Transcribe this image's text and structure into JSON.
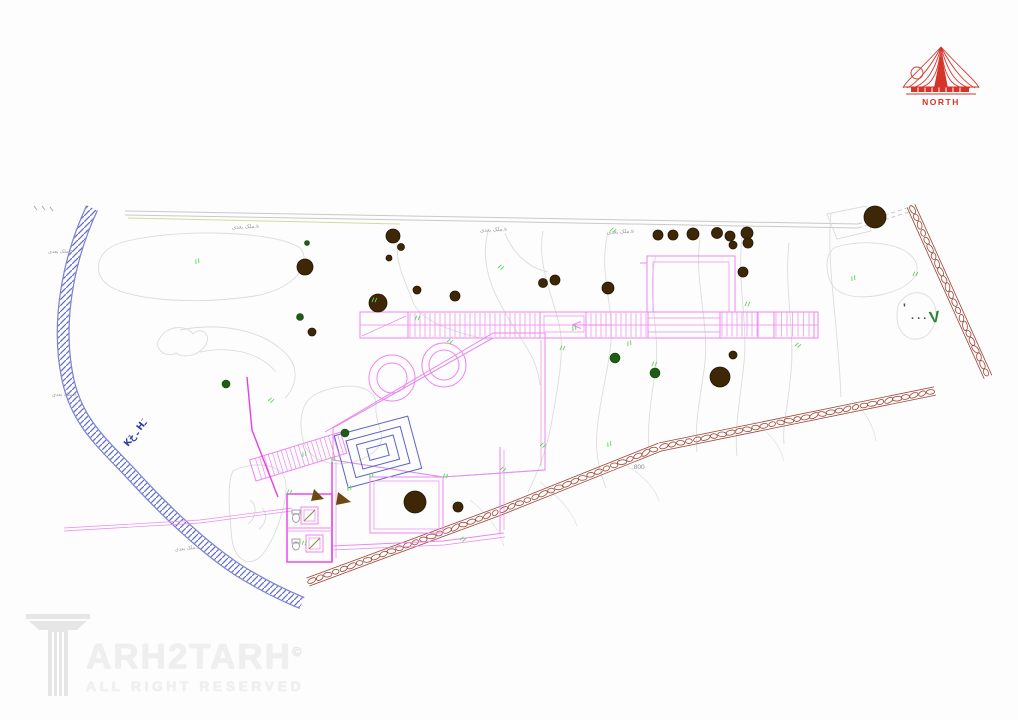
{
  "page": {
    "background": "#fdfdfd"
  },
  "north": {
    "label": "NORTH",
    "color": "#d5342b"
  },
  "watermark": {
    "brand": "ARH2TARH",
    "copyright": "©",
    "tagline": "ALL RIGHT RESERVED"
  },
  "colors": {
    "magenta": "#ef86ef",
    "magenta_bright": "#e63fe6",
    "cyan": "#8ce7ef",
    "cyan_hatch": "#7fdde8",
    "contour": "#dcdcdc",
    "road": "#c9c9c9",
    "olive": "#d8da95",
    "river": "#7b84cf",
    "river_hatch": "#6670c5",
    "stone": "#9c4434",
    "tree": "#3d2706",
    "tree_edge": "#241502",
    "shrub": "#1e5e14",
    "green": "#5ad45a",
    "label": "#9a9a9a",
    "dim": "#4a4a4a",
    "blue_text": "#2b3ba8",
    "green_digit": "#2f8032",
    "red": "#d5342b"
  },
  "annotations": [
    {
      "text": "ملک بعدی.s",
      "x": 232,
      "y": 229,
      "rot": -3,
      "size": 5.5,
      "color": "#9a9a9a"
    },
    {
      "text": "ملک بعدی.s",
      "x": 480,
      "y": 232,
      "rot": -3,
      "size": 5.5,
      "color": "#9a9a9a"
    },
    {
      "text": "ملک بعدی.s",
      "x": 607,
      "y": 234,
      "rot": -3,
      "size": 5.5,
      "color": "#9a9a9a"
    },
    {
      "text": "ملک بعدی.s",
      "x": 48,
      "y": 253,
      "rot": 0,
      "size": 5,
      "color": "#9a9a9a"
    },
    {
      "text": "ملک بعدی.s",
      "x": 52,
      "y": 396,
      "rot": 0,
      "size": 5,
      "color": "#9a9a9a"
    },
    {
      "text": "ملک بعدی.s",
      "x": 175,
      "y": 551,
      "rot": -6,
      "size": 5,
      "color": "#9a9a9a"
    },
    {
      "text": ":800",
      "x": 632,
      "y": 469,
      "rot": 0,
      "size": 6.5,
      "color": "#8a8a8a"
    },
    {
      "text": "'",
      "x": 903,
      "y": 312,
      "rot": 0,
      "size": 12,
      "color": "#4a4a4a",
      "bold": true
    },
    {
      "text": ". . .",
      "x": 911,
      "y": 319,
      "rot": 0,
      "size": 11,
      "color": "#4a4a4a",
      "bold": true
    },
    {
      "text": "V",
      "x": 930,
      "y": 323,
      "rot": -8,
      "size": 16,
      "color": "#2f8032",
      "bold": true
    },
    {
      "text": "Kَـ خ Hَـ",
      "x": 128,
      "y": 447,
      "rot": -52,
      "size": 9,
      "color": "#2b3ba8",
      "bold": true
    }
  ],
  "trees": [
    [
      305,
      267,
      8
    ],
    [
      378,
      303,
      9
    ],
    [
      312,
      332,
      4
    ],
    [
      393,
      236,
      7
    ],
    [
      401,
      247,
      3.5
    ],
    [
      389,
      258,
      3
    ],
    [
      417,
      290,
      4
    ],
    [
      455,
      296,
      5
    ],
    [
      543,
      283,
      4.5
    ],
    [
      555,
      280,
      5
    ],
    [
      608,
      288,
      6
    ],
    [
      658,
      235,
      5
    ],
    [
      673,
      235,
      5
    ],
    [
      693,
      234,
      6
    ],
    [
      717,
      233,
      5.5
    ],
    [
      730,
      236,
      5
    ],
    [
      747,
      233,
      6
    ],
    [
      733,
      245,
      4
    ],
    [
      748,
      243,
      5
    ],
    [
      743,
      272,
      5
    ],
    [
      733,
      355,
      4
    ],
    [
      720,
      377,
      10
    ],
    [
      875,
      217,
      11
    ],
    [
      415,
      502,
      11
    ],
    [
      458,
      507,
      5
    ]
  ],
  "shrubs": [
    [
      307,
      243,
      2.5
    ],
    [
      300,
      317,
      3.5
    ],
    [
      615,
      358,
      5
    ],
    [
      655,
      373,
      5
    ],
    [
      226,
      384,
      4
    ],
    [
      345,
      433,
      4
    ]
  ],
  "survey_marks": [
    [
      196,
      264
    ],
    [
      372,
      302
    ],
    [
      268,
      401
    ],
    [
      303,
      457
    ],
    [
      560,
      350
    ],
    [
      610,
      231
    ],
    [
      628,
      346
    ],
    [
      745,
      306
    ],
    [
      795,
      346
    ],
    [
      852,
      281
    ],
    [
      913,
      276
    ],
    [
      498,
      268
    ],
    [
      573,
      331
    ],
    [
      652,
      366
    ],
    [
      540,
      446
    ],
    [
      608,
      447
    ],
    [
      415,
      320
    ],
    [
      447,
      342
    ],
    [
      370,
      478
    ],
    [
      443,
      478
    ],
    [
      500,
      470
    ],
    [
      332,
      462
    ],
    [
      287,
      494
    ],
    [
      460,
      540
    ],
    [
      348,
      491
    ],
    [
      302,
      545
    ]
  ]
}
